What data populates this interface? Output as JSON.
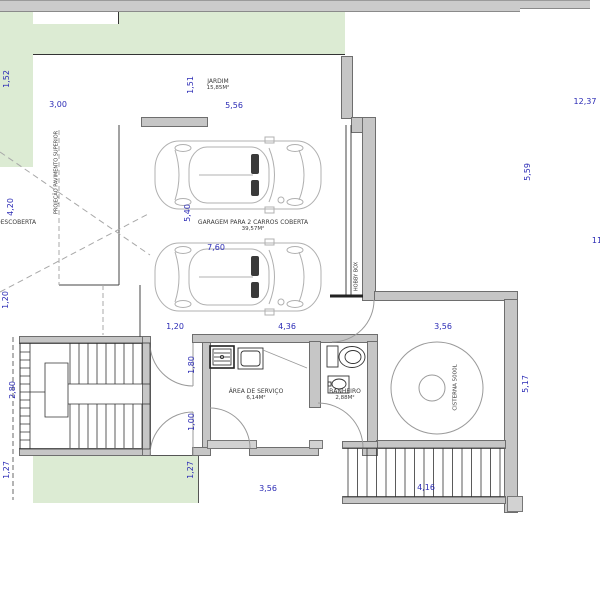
{
  "drawing": {
    "labels": {
      "jardim_name": "JARDIM",
      "jardim_area": "15,85M²",
      "garagem_name": "GARAGEM PARA 2 CARROS COBERTA",
      "garagem_area": "39,57M²",
      "servico_name": "ÁREA DE SERVIÇO",
      "servico_area": "6,14M²",
      "banheiro_name": "BANHEIRO",
      "banheiro_area": "2,88M²",
      "cisterna_name": "CISTERNA 5000L",
      "hobby_name": "HOBBY BOX",
      "descoberta_name": "DESCOBERTA",
      "projecao_name": "PROJEÇÃO PAVIMENTO SUPERIOR"
    },
    "dimensions": {
      "d152": "1,52",
      "d300": "3,00",
      "d151": "1,51",
      "d556": "5,56",
      "d1237": "12,37",
      "d559": "5,59",
      "d11": "11",
      "d420": "4,20",
      "d540": "5,40",
      "d760": "7,60",
      "d120_left": "1,20",
      "d120": "1,20",
      "d436": "4,36",
      "d356_top": "3,56",
      "d517": "5,17",
      "d180": "1,80",
      "d100": "1,00",
      "d280": "2,80",
      "d127_left": "1,27",
      "d127": "1,27",
      "d356_bottom": "3,56",
      "d416": "4,16"
    },
    "colors": {
      "dimension_text": "#2b2bb5",
      "wall_fill": "#c6c6c6",
      "garden_fill": "#dcebd3",
      "paving_fill": "#cbcbcb",
      "label_text": "#3a3a3a"
    }
  }
}
